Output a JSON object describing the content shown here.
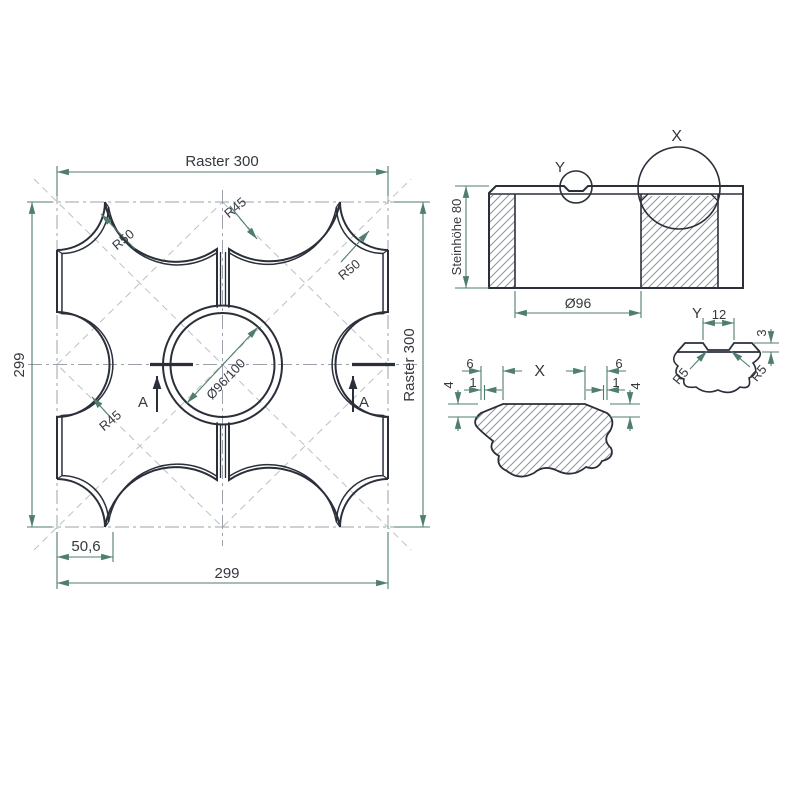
{
  "drawing": {
    "type": "technical-drawing",
    "subject": "grid paving stone with center bore, plan + section + details"
  },
  "colors": {
    "line": "#2b2f3a",
    "dimension": "#4f7d6e",
    "centerline": "#9ba1a8",
    "construction": "#bcc0c5",
    "hatch": "#8f939a",
    "text": "#35383f",
    "background": "#ffffff"
  },
  "plan": {
    "dim_raster_top": "Raster 300",
    "dim_raster_right": "Raster 300",
    "dim_height_left": "299",
    "dim_width_bottom": "299",
    "dim_offset": "50,6",
    "radius_top_left": "R50",
    "radius_top_center": "R45",
    "radius_right": "R50",
    "radius_left": "R45",
    "dim_center_bore": "Ø96/100",
    "section_label_left": "A",
    "section_label_right": "A"
  },
  "section": {
    "dim_stone_height": "Steinhöhe 80",
    "dim_bore": "Ø96",
    "detail_marker_x": "X",
    "detail_marker_y": "Y"
  },
  "detail_x": {
    "title": "X",
    "left": {
      "chamfer_width": "6",
      "edge": "1",
      "chamfer_height": "4"
    },
    "right": {
      "chamfer_width": "6",
      "edge": "1",
      "chamfer_height": "4"
    }
  },
  "detail_y": {
    "title": "Y",
    "groove_width": "12",
    "groove_depth": "3",
    "radius_left": "R5",
    "radius_right": "R5"
  }
}
